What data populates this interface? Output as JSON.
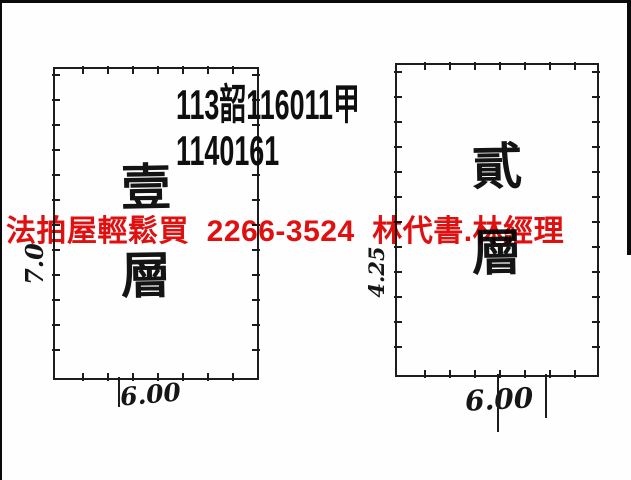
{
  "page": {
    "background_color": "#fefefe",
    "ink_color": "#1c1c1c"
  },
  "header": {
    "line1": "113韶116011甲",
    "line2": "1140161"
  },
  "watermark": {
    "text": "法拍屋輕鬆買  2266-3524  林代書.林經理",
    "color": "#e01010"
  },
  "plans": [
    {
      "label": "壹層",
      "chars": [
        "壹",
        "層"
      ],
      "west_dim": "7.0",
      "south_dim": "6.00"
    },
    {
      "label": "貳層",
      "chars": [
        "貳",
        "層"
      ],
      "west_dim": "4.25",
      "south_dim": "6.00"
    }
  ]
}
